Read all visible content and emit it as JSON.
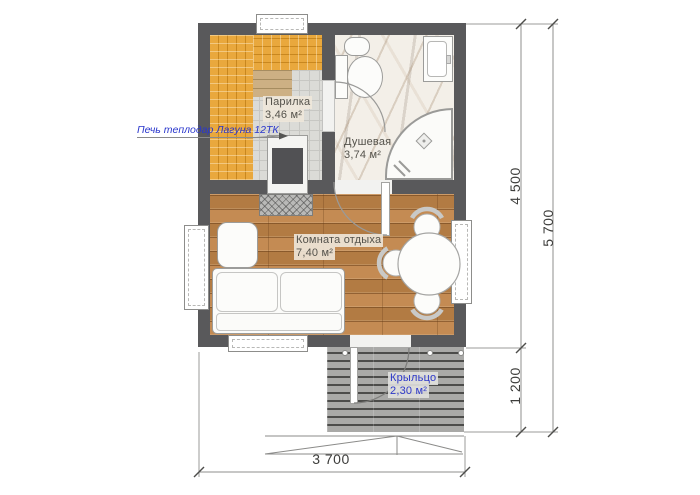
{
  "drawing": {
    "kind": "bath-house floor plan"
  },
  "rooms": {
    "sauna": {
      "name": "Парилка",
      "area": "3,46 м²"
    },
    "shower": {
      "name": "Душевая",
      "area": "3,74 м²"
    },
    "lounge": {
      "name": "Комната отдыха",
      "area": "7,40 м²"
    },
    "porch": {
      "name": "Крыльцо",
      "area": "2,30 м²"
    }
  },
  "annotations": {
    "stove_label": "Печь теплодар Лагуна 12ТК"
  },
  "dimensions": {
    "overall_width": "3 700",
    "main_depth": "4 500",
    "total_depth": "5 700",
    "porch_depth": "1 200"
  },
  "colors": {
    "wall": "#59595b",
    "bench_wood": "#e9a83d",
    "floor_wood": "#c08448",
    "porch_deck": "#a9a9a7",
    "annotation_blue": "#2936cc"
  }
}
